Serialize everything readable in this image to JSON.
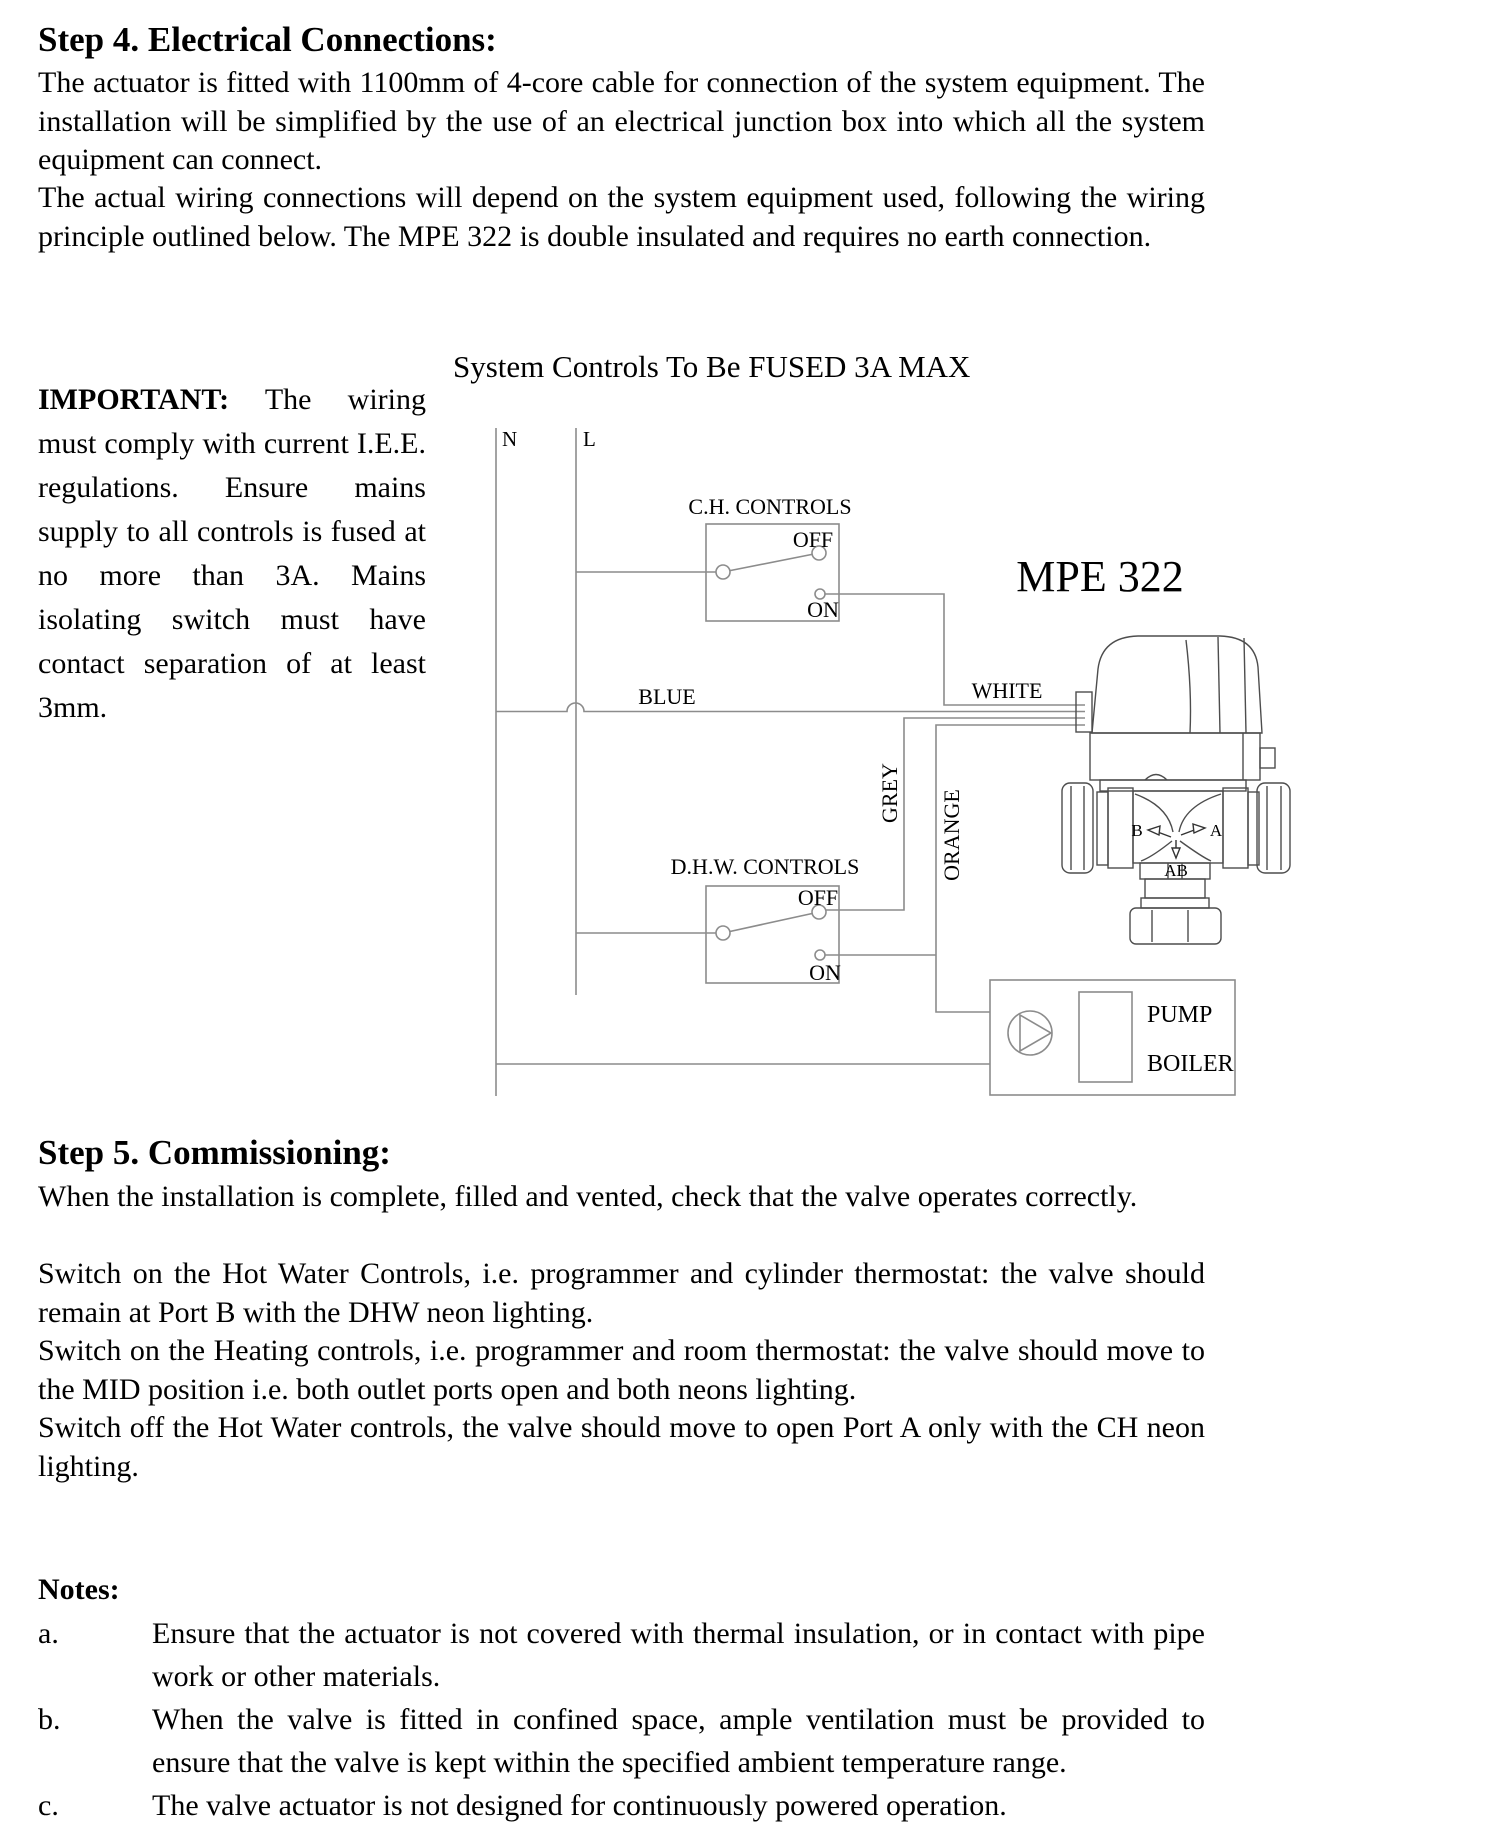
{
  "step4": {
    "heading": "Step 4. Electrical Connections:",
    "para1": "The actuator is fitted with 1100mm of 4-core cable for connection of the system equipment. The installation will be simplified by the use of an electrical junction box into which all the system equipment can connect.",
    "para2": "The actual wiring connections will depend on the system equipment used, following the wiring principle outlined below. The MPE 322 is double insulated and requires no earth connection."
  },
  "important": {
    "label": "IMPORTANT:",
    "text": "The wiring must comply with current I.E.E. regulations. Ensure mains supply to all controls is fused at no more than 3A. Mains isolating switch must have contact separation of at least 3mm."
  },
  "diagram": {
    "title": "System Controls To Be FUSED 3A MAX",
    "neutral_label": "N",
    "live_label": "L",
    "ch_controls_label": "C.H. CONTROLS",
    "ch_off_label": "OFF",
    "ch_on_label": "ON",
    "dhw_controls_label": "D.H.W. CONTROLS",
    "dhw_off_label": "OFF",
    "dhw_on_label": "ON",
    "blue_wire_label": "BLUE",
    "white_wire_label": "WHITE",
    "grey_wire_label": "GREY",
    "orange_wire_label": "ORANGE",
    "valve_model": "MPE 322",
    "port_b_label": "B",
    "port_a_label": "A",
    "port_ab_label": "AB",
    "pump_label": "PUMP",
    "boiler_label": "BOILER"
  },
  "step5": {
    "heading": "Step 5. Commissioning:",
    "para1": "When the installation is complete, filled and vented, check that the valve operates correctly.",
    "para2": "Switch on the Hot Water Controls, i.e. programmer and cylinder thermostat: the valve should remain at Port B with the DHW neon lighting.",
    "para3": "Switch on the Heating controls, i.e. programmer and room thermostat: the valve should move to the MID position i.e. both outlet ports open and both neons lighting.",
    "para4": "Switch off the Hot Water controls, the valve should move to open Port A only with the CH neon lighting."
  },
  "notes": {
    "heading": "Notes:",
    "items": [
      {
        "label": "a.",
        "text": "Ensure that the actuator is not covered with thermal insulation, or in contact with pipe work or other materials."
      },
      {
        "label": "b.",
        "text": "When the valve is fitted in confined space, ample ventilation must be provided to ensure that the valve is kept within the specified ambient temperature range."
      },
      {
        "label": "c.",
        "text": "The valve actuator is not designed for continuously powered operation."
      }
    ]
  }
}
